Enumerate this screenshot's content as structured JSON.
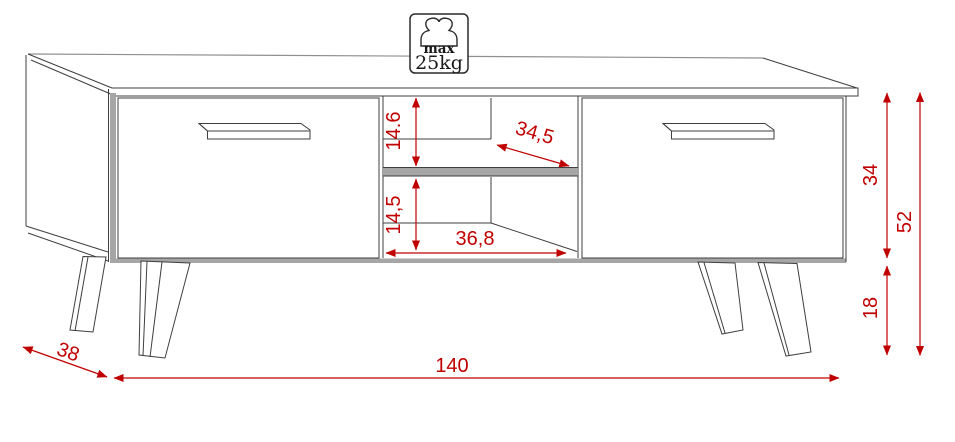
{
  "diagram": {
    "title": "TV stand dimension drawing",
    "weight_badge": {
      "line1": "max",
      "line2": "25kg"
    },
    "dimensions": {
      "top_opening_height": "14.6",
      "bottom_opening_height": "14,5",
      "opening_depth": "34,5",
      "opening_width": "36,8",
      "body_height": "34",
      "total_height": "52",
      "leg_height": "18",
      "total_width": "140",
      "total_depth": "38"
    },
    "colors": {
      "dimension_red": "#c00000",
      "outline": "#3f3f3f",
      "shade_gray": "#a6a6a6"
    }
  }
}
